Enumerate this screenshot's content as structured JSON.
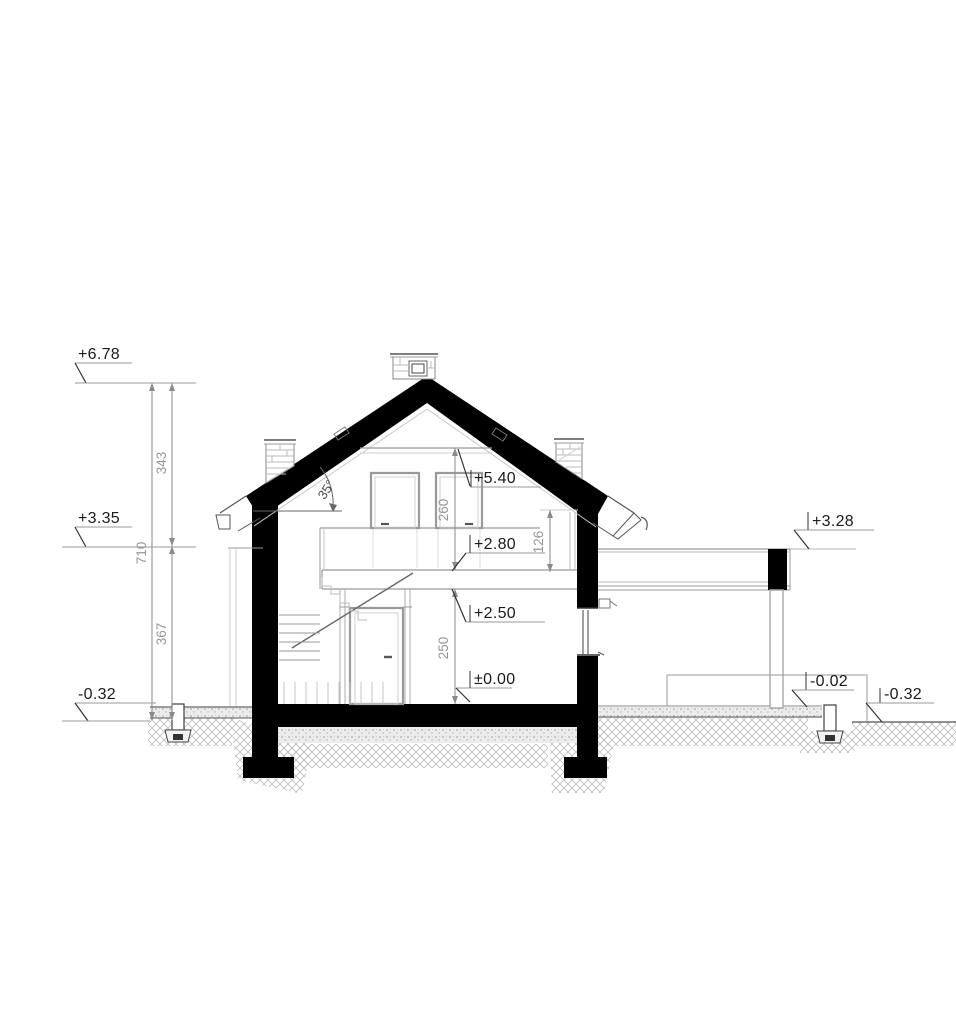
{
  "drawing": {
    "kind": "house-cross-section-architectural-drawing",
    "colors": {
      "cut_fill": "#000000",
      "thin_line": "#aaaaaa",
      "mid_line": "#777777",
      "marker_text": "#1a1a1a",
      "dim_text": "#979797"
    },
    "markers": {
      "ridge": "+6.78",
      "eaves_left": "+3.35",
      "ground_left": "-0.32",
      "collar": "+5.40",
      "attic_floor": "+2.80",
      "ground_ceiling": "+2.50",
      "ground_floor": "±0.00",
      "annex_roof": "+3.28",
      "annex_floor": "-0.02",
      "ground_right": "-0.32"
    },
    "dims": {
      "total_height": "710",
      "upper_height": "343",
      "lower_height": "367",
      "attic_room_height": "260",
      "ground_room_height": "250",
      "knee_wall_height": "126",
      "roof_pitch": "35°"
    }
  }
}
